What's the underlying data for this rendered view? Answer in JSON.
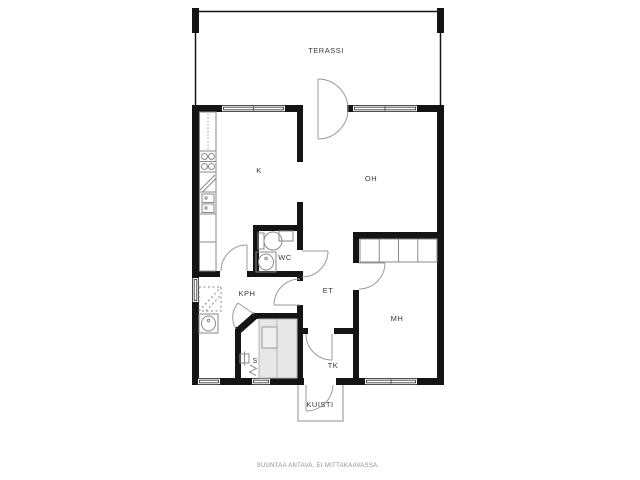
{
  "plan": {
    "rooms": {
      "terassi": "TERASSI",
      "k": "K",
      "oh": "OH",
      "wc": "WC",
      "kph": "KPH",
      "et": "ET",
      "mh": "MH",
      "tk": "TK",
      "s": "S",
      "kuisti": "KUISTI"
    },
    "footer_note": "SUUNTAA ANTAVA, EI MITTAKAAVASSA.",
    "colors": {
      "wall": "#141414",
      "thin_line": "#8f8f8f",
      "bench": "#e7e7e7",
      "label_text": "#3a3a3a",
      "footer_text": "#909090",
      "background": "#ffffff"
    }
  }
}
